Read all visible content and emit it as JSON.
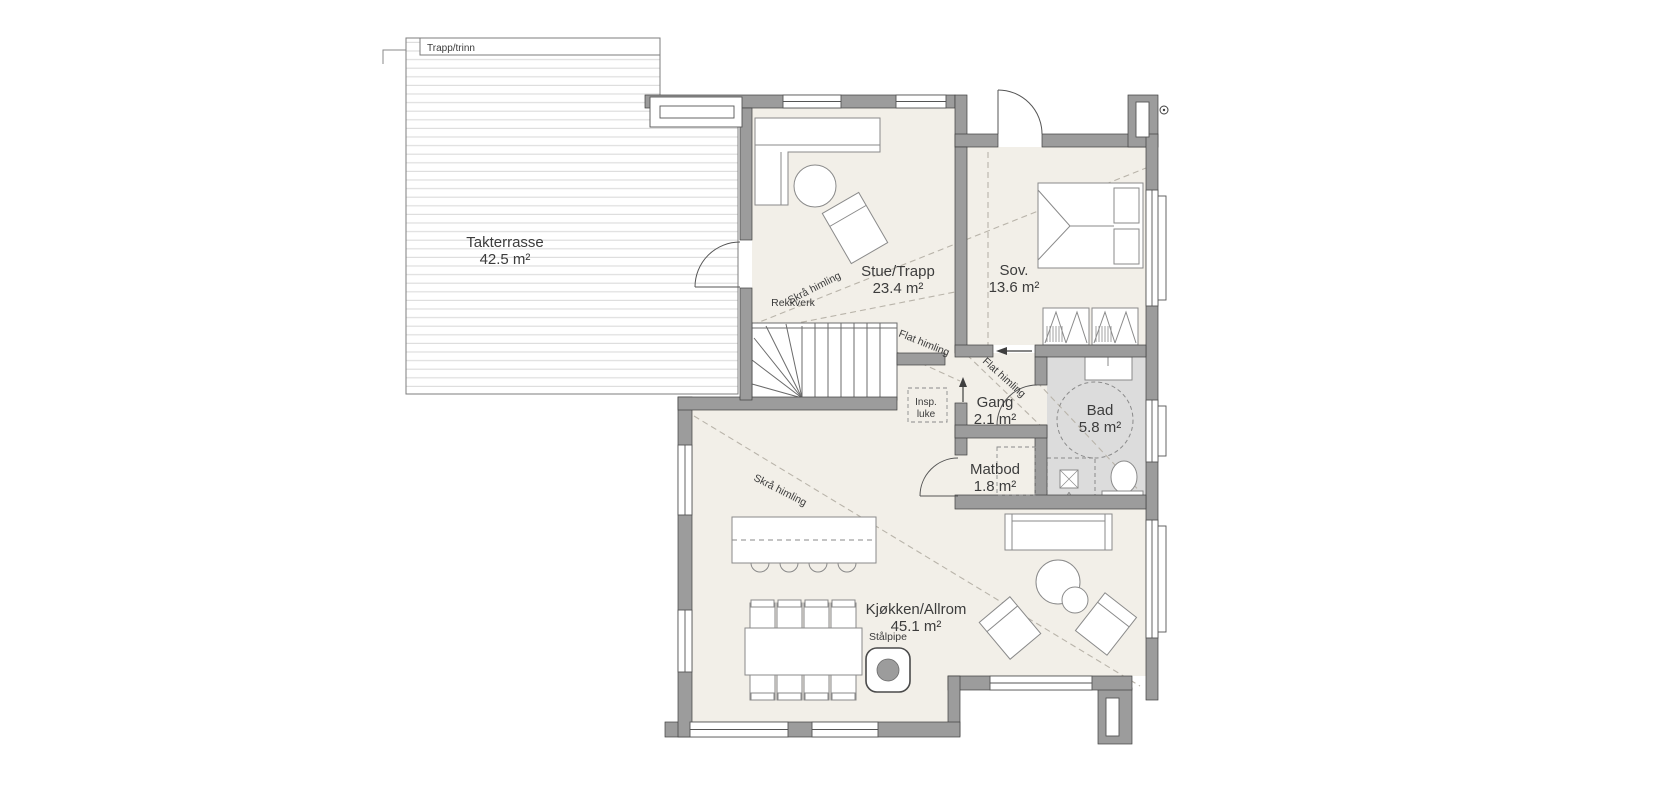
{
  "plan": {
    "terrace": {
      "label": "Takterrasse",
      "area": "42.5 m²",
      "top_strip_label": "Trapp/trinn"
    },
    "rooms": [
      {
        "id": "stue",
        "label": "Stue/Trapp",
        "area": "23.4 m²"
      },
      {
        "id": "sov",
        "label": "Sov.",
        "area": "13.6 m²"
      },
      {
        "id": "gang",
        "label": "Gang",
        "area": "2.1 m²"
      },
      {
        "id": "bad",
        "label": "Bad",
        "area": "5.8 m²"
      },
      {
        "id": "matbod",
        "label": "Matbod",
        "area": "1.8 m²"
      },
      {
        "id": "kjokken",
        "label": "Kjøkken/Allrom",
        "area": "45.1 m²"
      }
    ],
    "annotations": {
      "rekkverk": "Rekkverk",
      "insp_luke_line1": "Insp.",
      "insp_luke_line2": "luke",
      "skra_himling": "Skrå himling",
      "flat_himling": "Flat himling",
      "stalpipe": "Stålpipe"
    },
    "colors": {
      "floor": "#f2efe8",
      "bathroom_floor": "#dcdcdc",
      "wall": "#9c9c9c",
      "outline": "#3f3f3f",
      "dash_line": "#b9b4aa",
      "deck_line": "#dedede"
    }
  }
}
